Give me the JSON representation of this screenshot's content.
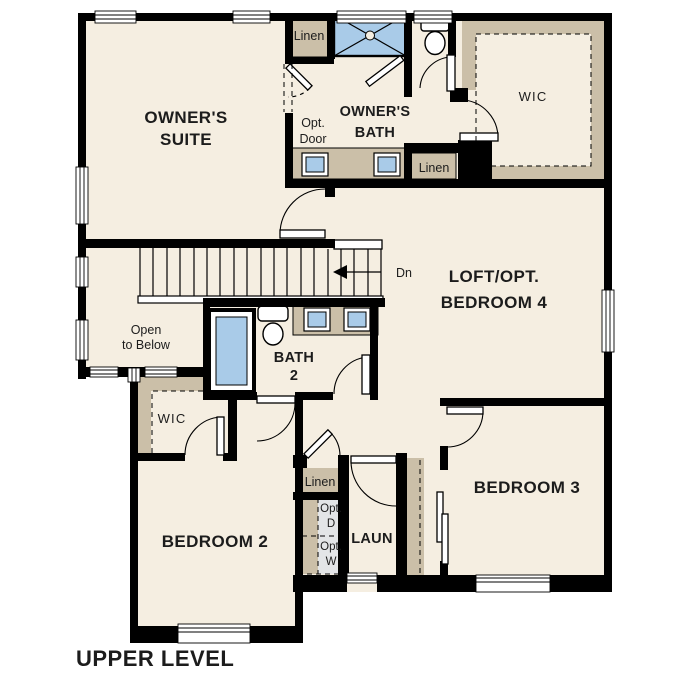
{
  "title": "UPPER LEVEL",
  "colors": {
    "wall": "#000000",
    "floor": "#f5eee1",
    "cabinet": "#cbbfa8",
    "fixture_blue": "#a9cbe8",
    "appliance_gray": "#e3e5e7",
    "background": "#ffffff",
    "text": "#1c1c1c"
  },
  "rooms": {
    "owners_suite": {
      "line1": "OWNER'S",
      "line2": "SUITE"
    },
    "owners_bath": {
      "line1": "OWNER'S",
      "line2": "BATH"
    },
    "wic_top": "WIC",
    "loft": {
      "line1": "LOFT/OPT.",
      "line2": "BEDROOM 4"
    },
    "open_below": {
      "line1": "Open",
      "line2": "to Below"
    },
    "bath2": {
      "line1": "BATH",
      "line2": "2"
    },
    "wic_bed2": "WIC",
    "bedroom2": "BEDROOM 2",
    "bedroom3": "BEDROOM 3",
    "laundry": "LAUN"
  },
  "closets": {
    "linen_top": "Linen",
    "linen_bath": "Linen",
    "linen_hall": "Linen"
  },
  "annotations": {
    "opt_door": {
      "line1": "Opt.",
      "line2": "Door"
    },
    "stair_direction": "Dn",
    "opt_dryer": {
      "line1": "Opt.",
      "line2": "D"
    },
    "opt_washer": {
      "line1": "Opt.",
      "line2": "W"
    }
  }
}
